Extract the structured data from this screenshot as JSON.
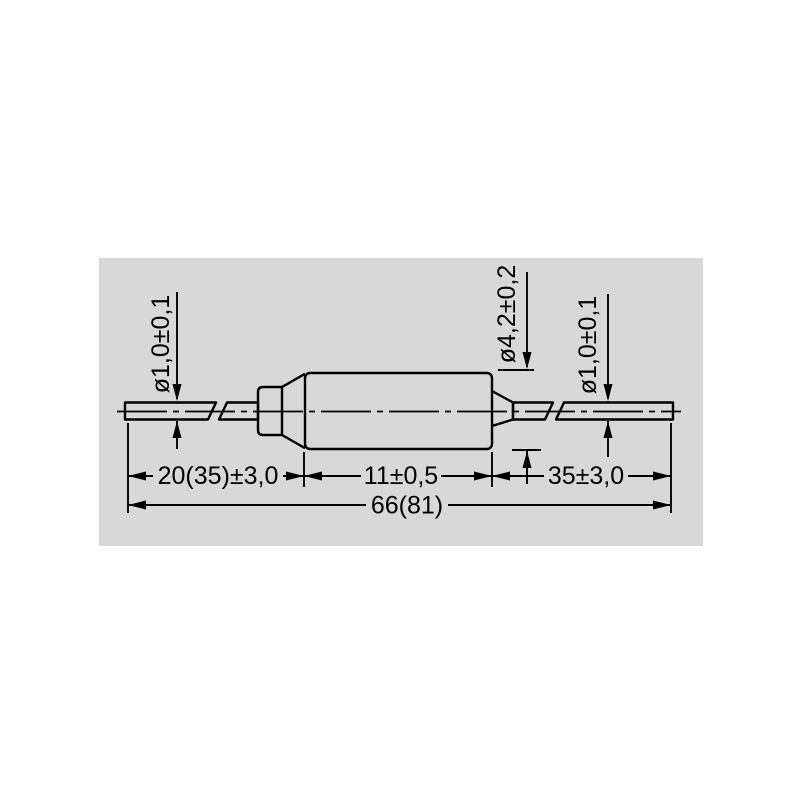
{
  "colors": {
    "background": "#ffffff",
    "panel": "#d8d8d8",
    "line": "#000000"
  },
  "dimensions": {
    "left_lead_diameter": "ø1,0±0,1",
    "body_diameter": "ø4,2±0,2",
    "right_lead_diameter": "ø1,0±0,1",
    "left_lead_length": "20(35)±3,0",
    "body_length": "11±0,5",
    "right_lead_length": "35±3,0",
    "overall_length": "66(81)"
  }
}
